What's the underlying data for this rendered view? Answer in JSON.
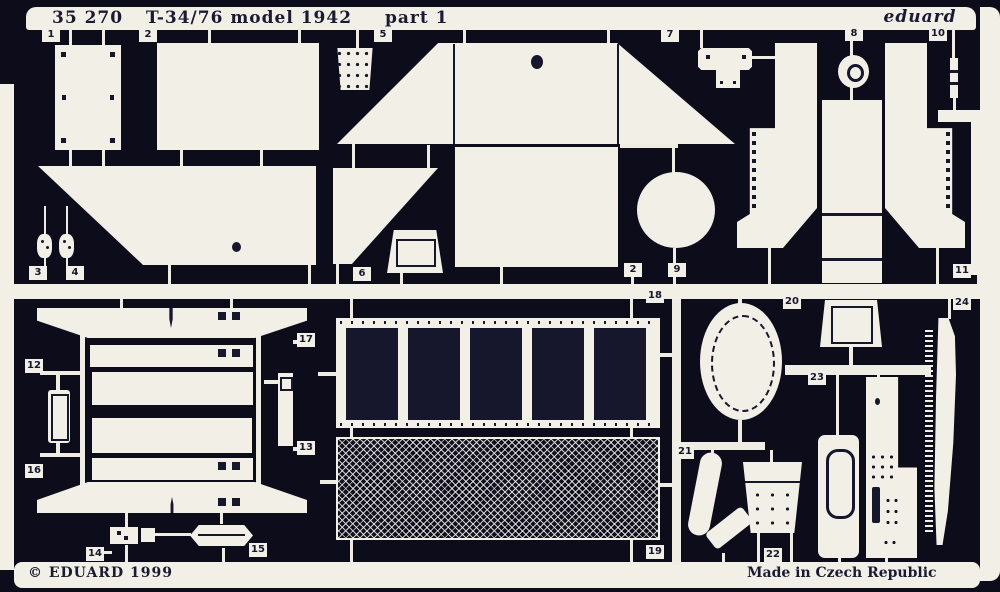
{
  "sheet": {
    "catalog_number": "35 270",
    "subject": "T-34/76 model 1942",
    "sheet_name": "part 1",
    "brand": "eduard",
    "copyright": "© EDUARD 1999",
    "origin": "Made in Czech Republic"
  },
  "part_labels": [
    "1",
    "2",
    "5",
    "7",
    "8",
    "10",
    "3",
    "4",
    "6",
    "2",
    "9",
    "11",
    "12",
    "16",
    "17",
    "13",
    "14",
    "15",
    "18",
    "19",
    "20",
    "23",
    "21",
    "22",
    "24"
  ],
  "colors": {
    "background": "#0c0c1b",
    "metal": "#f2efe7",
    "etch_dark": "#16162c"
  }
}
